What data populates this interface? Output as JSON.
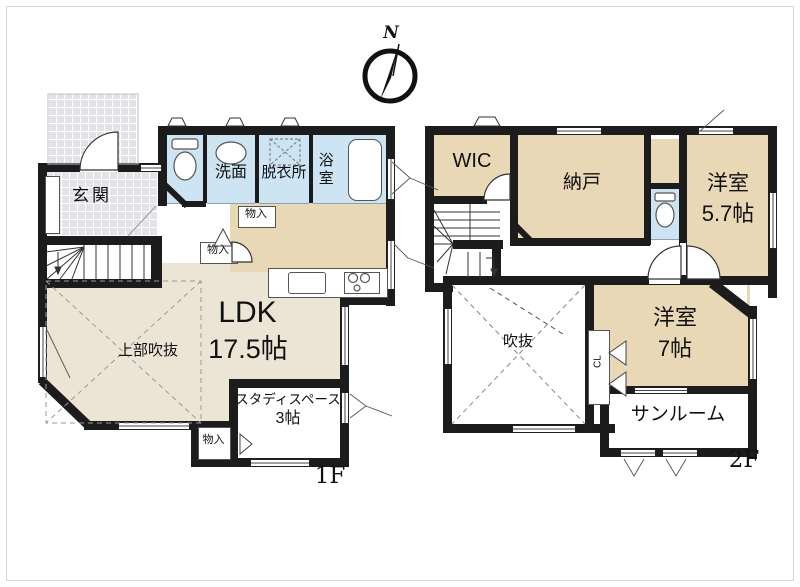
{
  "colors": {
    "wall": "#1c1c1c",
    "room_tan": "#e9d8b6",
    "room_beige": "#ece5d6",
    "wet_blue": "#cde4f2",
    "tile_gray": "#e4e4e8",
    "closet_tan": "#e6d2a6",
    "bg": "#ffffff"
  },
  "compass": {
    "label": "N"
  },
  "floor1": {
    "floor_label": "1F",
    "rooms": {
      "genkan": "玄関",
      "senmen": "洗面",
      "datsuisho": "脱衣所",
      "yokushitsu": "浴室",
      "ldk": "LDK",
      "ldk_size": "17.5帖",
      "jobu_fukinuke": "上部吹抜",
      "study": "スタディスペース",
      "study_size": "3帖",
      "monoire": "物入"
    }
  },
  "floor2": {
    "floor_label": "2F",
    "rooms": {
      "wic": "WIC",
      "nando": "納戸",
      "yoshitsu_5_7": "洋室",
      "yoshitsu_5_7_size": "5.7帖",
      "yoshitsu_7": "洋室",
      "yoshitsu_7_size": "7帖",
      "fukinuke": "吹抜",
      "sunroom": "サンルーム",
      "closet": "CL"
    }
  }
}
